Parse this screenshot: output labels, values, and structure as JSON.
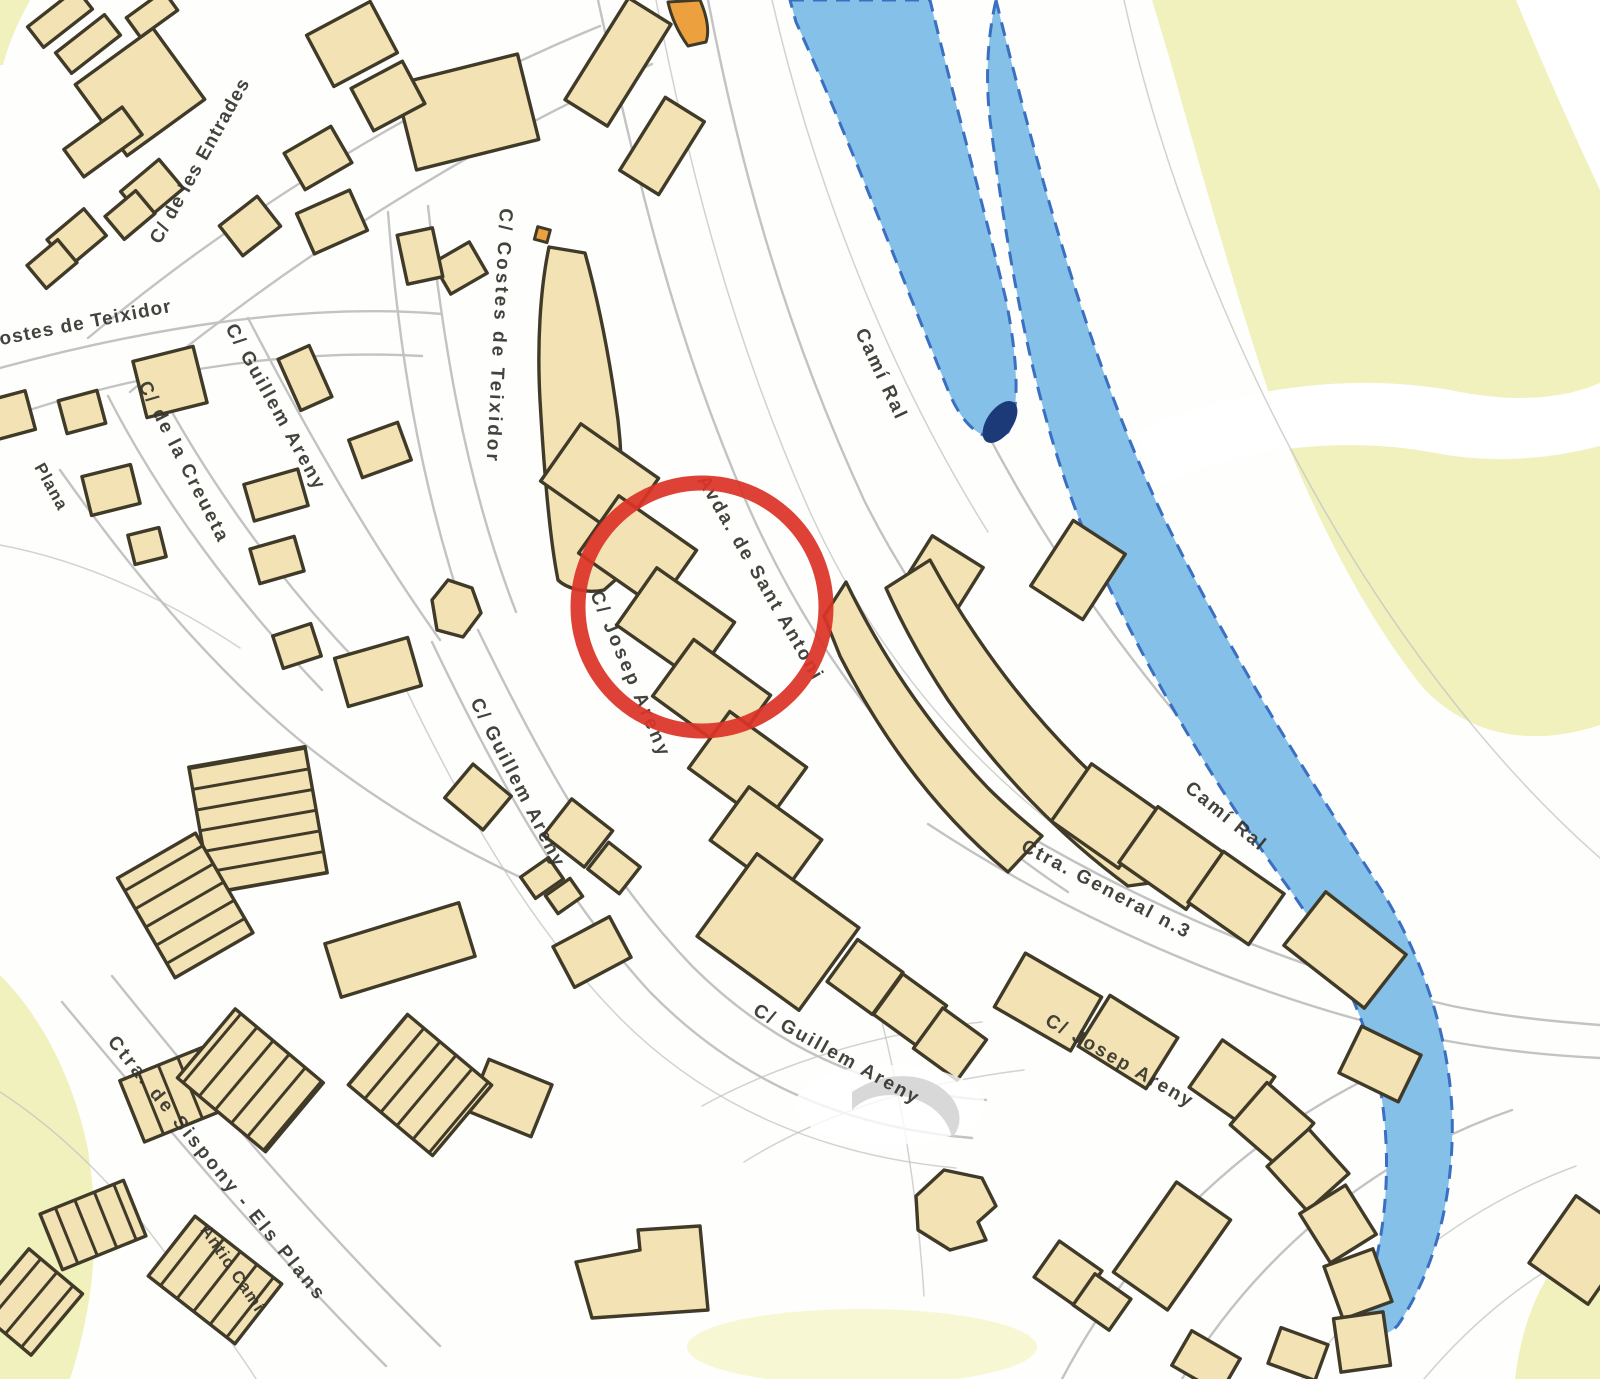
{
  "page": {
    "kind": "scanned cadastral street map",
    "content": "town street map with highlighted location"
  },
  "colors": {
    "background": "#ffffff",
    "building": "#f3e2b4",
    "building_outline": "#403a28",
    "building_orange": "#eda13e",
    "road_line": "#c3c3c3",
    "water": "#85c0e8",
    "water_edge": "#3a6fc2",
    "water_deep": "#1c3a78",
    "open_land": "#f0f1bd",
    "open_land_soft": "#f7f8d3",
    "highlight": "#dc3427",
    "label_text": "#35332c",
    "watermark": "#d4d4d4"
  },
  "street_labels": [
    {
      "id": "entrades",
      "text": "C/ de les Entrades"
    },
    {
      "id": "costes-teixidor-left",
      "text": "Costes de Teixidor"
    },
    {
      "id": "costes-teixidor-center",
      "text": "C/ Costes de Teixidor"
    },
    {
      "id": "creueta",
      "text": "C/ de la Creueta"
    },
    {
      "id": "guillem-areny-upper",
      "text": "C/ Guillem Areny"
    },
    {
      "id": "guillem-areny-middle",
      "text": "C/ Guillem Areny"
    },
    {
      "id": "guillem-areny-lower",
      "text": "C/ Guillem Areny"
    },
    {
      "id": "josep-areny-center",
      "text": "C/ Josep Areny"
    },
    {
      "id": "sant-antoni",
      "text": "Avda. de Sant Antoni"
    },
    {
      "id": "cami-ral-upper",
      "text": "Camí Ral"
    },
    {
      "id": "cami-ral-right",
      "text": "Camí Ral"
    },
    {
      "id": "ctra-general",
      "text": "Ctra. General n.3"
    },
    {
      "id": "josep-areny-bottom",
      "text": "C/ Josep Areny"
    },
    {
      "id": "sispony",
      "text": "Ctra. de Sispony - Els Plans"
    },
    {
      "id": "antic-cami",
      "text": "Antic Camí"
    },
    {
      "id": "plana",
      "text": "Plana"
    }
  ],
  "annotation": {
    "shape": "circle",
    "color": "#dc3427"
  }
}
